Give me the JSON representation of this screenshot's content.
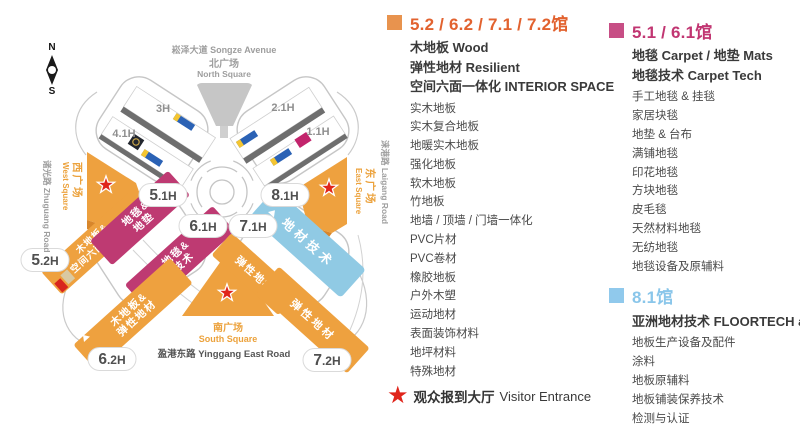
{
  "map": {
    "compass": {
      "north": "N",
      "south": "S"
    },
    "roads": {
      "songze": "崧泽大道 Songze Avenue",
      "north_square_cn": "北广场",
      "north_square_en": "North Square",
      "south_square_cn": "南广场",
      "south_square_en": "South Square",
      "yinggang": "盈港东路 Yinggang East Road",
      "zhuguang": "诸光路 Zhuguang Road",
      "laigang": "涞港路 Laigang Road",
      "west_square_cn": "西广场",
      "west_square_en": "West Square",
      "east_square_cn": "东广场",
      "east_square_en": "East Square"
    },
    "halls": {
      "h3": "3H",
      "h21": "2.1H",
      "h41": "4.1H",
      "h11": "1.1H"
    },
    "pills": [
      {
        "big": "5",
        "rest": ".1H"
      },
      {
        "big": "8",
        "rest": ".1H"
      },
      {
        "big": "6",
        "rest": ".1H"
      },
      {
        "big": "7",
        "rest": ".1H"
      },
      {
        "big": "5",
        "rest": ".2H"
      },
      {
        "big": "6",
        "rest": ".2H"
      },
      {
        "big": "7",
        "rest": ".2H"
      }
    ],
    "wings": {
      "wood_interior": {
        "line1": "木地板&",
        "line2": "空间六面一体化"
      },
      "carpet_mats": {
        "line1": "地毯&",
        "line2": "地垫"
      },
      "carpet_tech": {
        "line1": "地毯&",
        "line2": "技术"
      },
      "wood_resilient": {
        "line1": "木地板&",
        "line2": "弹性地材"
      },
      "floortech": "地材技术",
      "resilient_upper": "弹性地材",
      "resilient_lower": "弹性地材"
    }
  },
  "legend": {
    "sections": [
      {
        "hall_label": "5.2 / 6.2 / 7.1 / 7.2馆",
        "color": "#E8934E",
        "headline1": "木地板 Wood",
        "headline2": "弹性地材 Resilient",
        "headline3": "空间六面一体化 INTERIOR SPACE",
        "items": [
          "实木地板",
          "实木复合地板",
          "地暖实木地板",
          "强化地板",
          "软木地板",
          "竹地板",
          "地墙 / 顶墙 / 门墙一体化",
          "PVC片材",
          "PVC卷材",
          "橡胶地板",
          "户外木塑",
          "运动地材",
          "表面装饰材料",
          "地坪材料",
          "特殊地材"
        ]
      },
      {
        "hall_label": "5.1 / 6.1馆",
        "color": "#C74E85",
        "headline1": "地毯 Carpet / 地垫 Mats",
        "headline2": "地毯技术 Carpet Tech",
        "items": [
          "手工地毯 & 挂毯",
          "家居块毯",
          "地垫 & 台布",
          "满铺地毯",
          "印花地毯",
          "方块地毯",
          "皮毛毯",
          "天然材料地毯",
          "无纺地毯",
          "地毯设备及原辅料"
        ]
      },
      {
        "hall_label": "8.1馆",
        "color": "#90C9EC",
        "headline1": "亚洲地材技术 FLOORTECH asia",
        "items": [
          "地板生产设备及配件",
          "涂料",
          "地板原辅料",
          "地板铺装保养技术",
          "检测与认证"
        ]
      }
    ],
    "star_glyph": "★",
    "visitor_entrance_cn": "观众报到大厅",
    "visitor_entrance_en": "Visitor Entrance"
  }
}
